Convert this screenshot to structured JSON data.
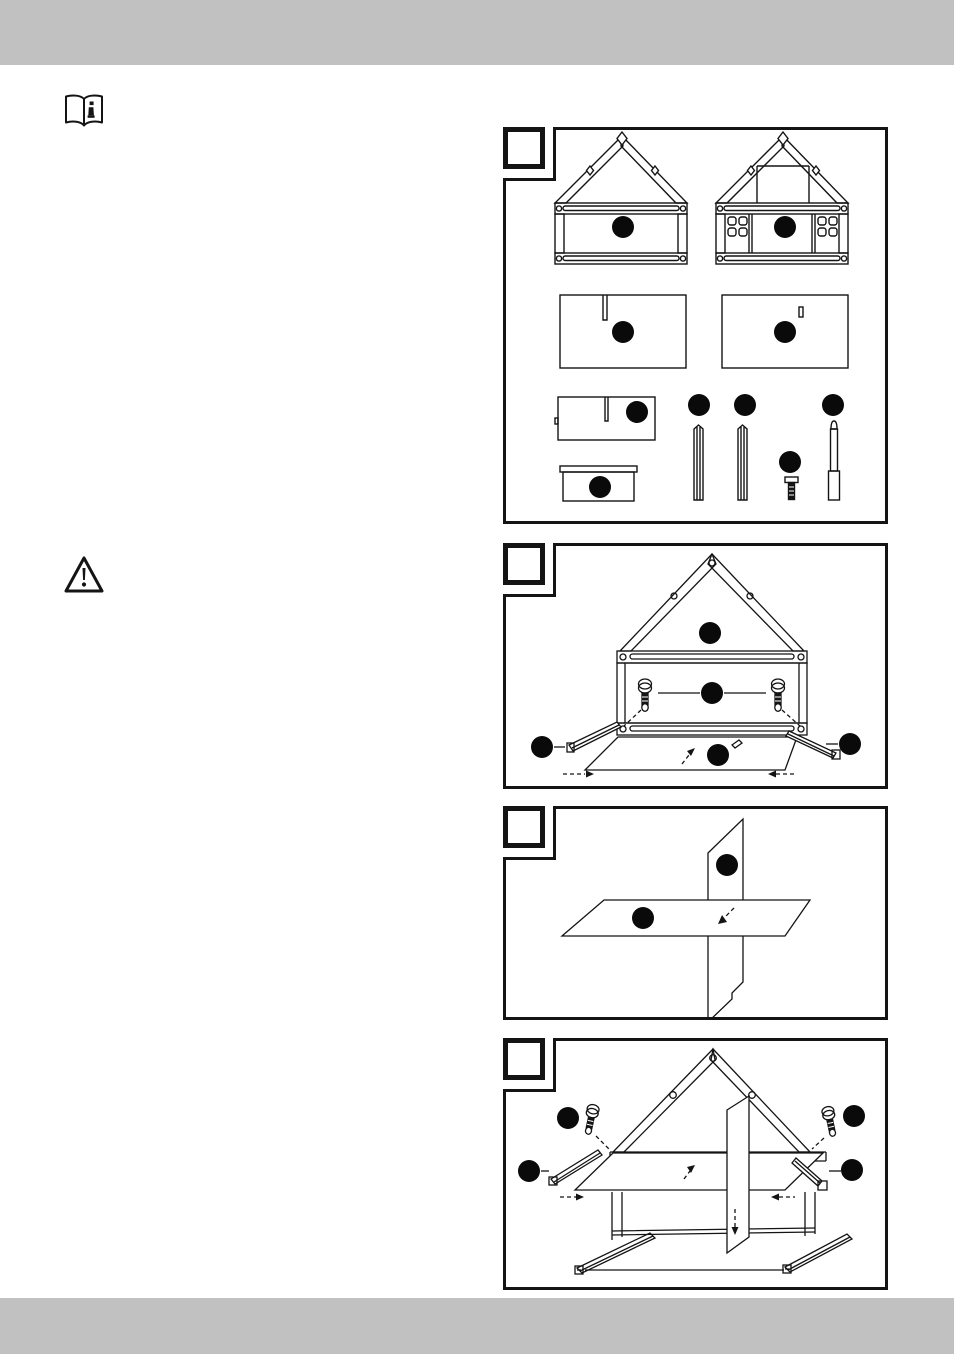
{
  "page": {
    "width_px": 954,
    "height_px": 1354,
    "top_bar_color": "#c1c1c1",
    "bottom_bar_color": "#c1c1c1",
    "paper_color": "#ffffff",
    "ink_color": "#141414"
  },
  "margin_icons": {
    "manual_icon": "open-book-with-info-symbol",
    "warning_icon": "triangle-with-exclamation-mark"
  },
  "steps": [
    {
      "name": "parts-overview",
      "step_number_label": "",
      "callout_circles": 10
    },
    {
      "name": "back-frame-and-rails",
      "step_number_label": "",
      "callout_circles": 5
    },
    {
      "name": "cross-lap-joint",
      "step_number_label": "",
      "callout_circles": 2
    },
    {
      "name": "insert-shelf-assembly",
      "step_number_label": "",
      "callout_circles": 4
    }
  ]
}
